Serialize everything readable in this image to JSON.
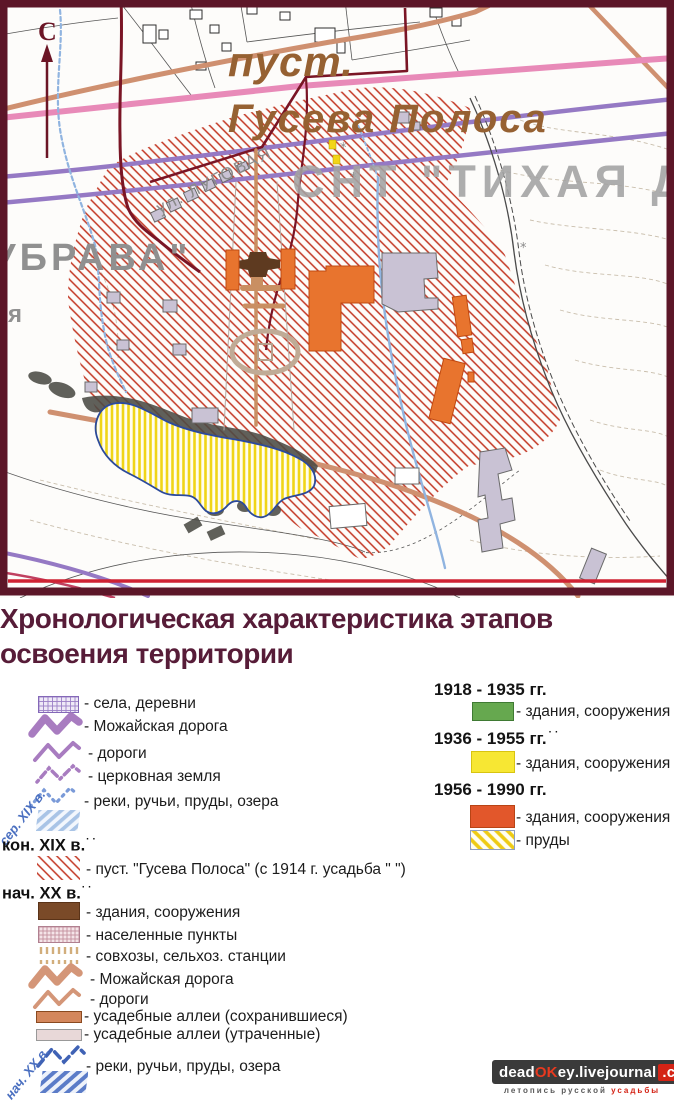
{
  "map": {
    "north_symbol": "С",
    "labels": {
      "pust": "пуст.",
      "guseva_polosa": "Гусева Полоса",
      "snt": "СНТ \"ТИХАЯ Д",
      "ubrava": "УБРАВА\"",
      "ya_fragment": "я",
      "street_lugovaya": "ул. ЛУГОВАЯ"
    }
  },
  "title": {
    "line1": "Хронологическая характеристика этапов",
    "line2": "освоения территории"
  },
  "legend": {
    "left": {
      "rotated_mid19": "сер. XIX в.",
      "villages": "- села, деревни",
      "mozhayskaya_road_19": "- Можайская дорога",
      "roads_19": "- дороги",
      "church_land": "- церковная земля",
      "rivers_19": "- реки, ручьи, пруды, озера",
      "era_late19": "кон. XIX в.",
      "era_late19_dots": "··",
      "pust_item": "- пуст. \"Гусева Полоса\" (с 1914 г. усадьба \"   \")",
      "era_early20": "нач. XX в.",
      "era_early20_dots": "··",
      "buildings_20": "- здания, сооружения",
      "settlements": "- населенные пункты",
      "sovkhoz": "- совхозы, сельхоз. станции",
      "mozhayskaya_road_20": "- Можайская дорога",
      "roads_20": "- дороги",
      "alleys_preserved": "- усадебные аллеи (сохранившиеся)",
      "alleys_lost": "- усадебные аллеи (утраченные)",
      "rotated_early20": "нач. XX в.",
      "rivers_20": "- реки, ручьи, пруды, озера"
    },
    "right": {
      "period1": "1918 - 1935 гг.",
      "period1_buildings": "- здания, сооружения",
      "period2": "1936 - 1955 гг.",
      "period2_dots": "··",
      "period2_buildings": "- здания, сооружения",
      "period3": "1956 - 1990 гг.",
      "period3_buildings": "- здания, сооружения",
      "period3_ponds": "- пруды"
    }
  },
  "watermark": {
    "part_dead": "dead",
    "part_ok": "OK",
    "part_ey": "ey",
    "part_livejournal": ".livejournal",
    "part_com": ".com",
    "caption_left": "летопись русской",
    "caption_right": "усадьбы"
  },
  "colors": {
    "frame_maroon": "#5c1628",
    "title_maroon": "#571c38",
    "hatch_red": "#c23522",
    "building_orange": "#e8742e",
    "building_green": "#66a84f",
    "building_yellow": "#f7e733",
    "building_brown": "#7a4a28",
    "pond_yellow": "#f0d517",
    "road_pink": "#e88ab8",
    "road_purple": "#9579c4",
    "road_tan": "#cf9070",
    "river_blue": "#90b4e0"
  }
}
